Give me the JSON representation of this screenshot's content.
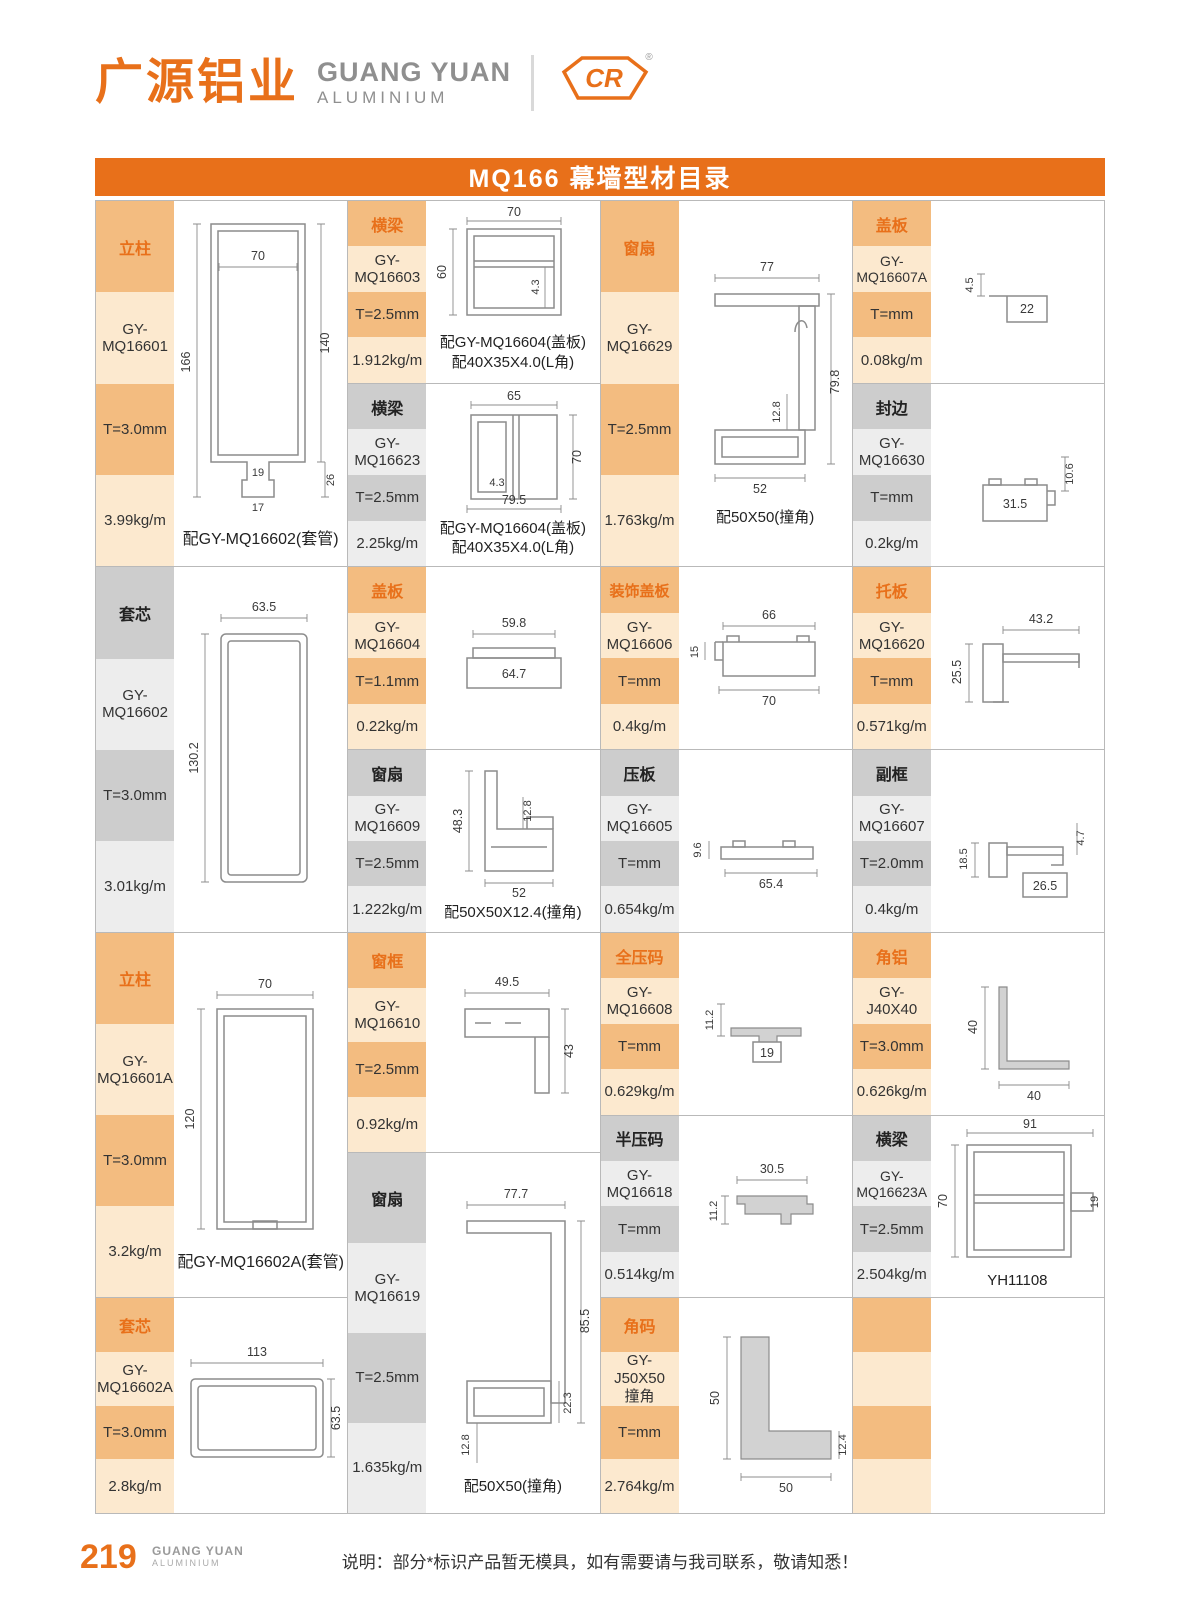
{
  "title": "MQ166 幕墙型材目录",
  "header": {
    "logo_cn": "广源铝业",
    "logo_en": "GUANG YUAN",
    "logo_en_sub": "ALUMINIUM",
    "badge": "CR",
    "registered": "®"
  },
  "footer": {
    "page": "219",
    "brand": "GUANG YUAN",
    "brand_sub": "ALUMINIUM",
    "note": "说明：部分*标识产品暂无模具，如有需要请与我司联系，敬请知悉！"
  },
  "colors": {
    "brand_orange": "#E8701A",
    "cell_orange_dark": "#F3BC80",
    "cell_orange_light": "#FCE9CF",
    "cell_gray_dark": "#CDCDCD",
    "cell_gray_light": "#EDEDED"
  },
  "columns": [
    {
      "blocks": [
        {
          "category": "立柱",
          "code": "GY-MQ16601",
          "thickness": "T=3.0mm",
          "weight": "3.99kg/m",
          "caption": [
            "配GY-MQ16602(套管)"
          ],
          "dims": [
            "70",
            "166",
            "140",
            "19",
            "26",
            "17"
          ]
        },
        {
          "category": "套芯",
          "code": "GY-MQ16602",
          "thickness": "T=3.0mm",
          "weight": "3.01kg/m",
          "caption": [],
          "dims": [
            "63.5",
            "130.2"
          ]
        },
        {
          "category": "立柱",
          "code": "GY-MQ16601A",
          "thickness": "T=3.0mm",
          "weight": "3.2kg/m",
          "caption": [
            "配GY-MQ16602A(套管)"
          ],
          "dims": [
            "70",
            "120"
          ]
        },
        {
          "category": "套芯",
          "code": "GY-MQ16602A",
          "thickness": "T=3.0mm",
          "weight": "2.8kg/m",
          "caption": [],
          "dims": [
            "113",
            "63.5"
          ]
        }
      ]
    },
    {
      "blocks": [
        {
          "category": "横梁",
          "code": "GY-MQ16603",
          "thickness": "T=2.5mm",
          "weight": "1.912kg/m",
          "caption": [
            "配GY-MQ16604(盖板)",
            "配40X35X4.0(L角)"
          ],
          "dims": [
            "70",
            "60",
            "4.3"
          ]
        },
        {
          "category": "横梁",
          "code": "GY-MQ16623",
          "thickness": "T=2.5mm",
          "weight": "2.25kg/m",
          "caption": [
            "配GY-MQ16604(盖板)",
            "配40X35X4.0(L角)"
          ],
          "dims": [
            "65",
            "4.3",
            "70",
            "79.5"
          ]
        },
        {
          "category": "盖板",
          "code": "GY-MQ16604",
          "thickness": "T=1.1mm",
          "weight": "0.22kg/m",
          "caption": [],
          "dims": [
            "59.8",
            "64.7"
          ]
        },
        {
          "category": "窗扇",
          "code": "GY-MQ16609",
          "thickness": "T=2.5mm",
          "weight": "1.222kg/m",
          "caption": [
            "配50X50X12.4(撞角)"
          ],
          "dims": [
            "48.3",
            "12.8",
            "52"
          ]
        },
        {
          "category": "窗框",
          "code": "GY-MQ16610",
          "thickness": "T=2.5mm",
          "weight": "0.92kg/m",
          "caption": [],
          "dims": [
            "49.5",
            "43"
          ]
        },
        {
          "category": "窗扇",
          "code": "GY-MQ16619",
          "thickness": "T=2.5mm",
          "weight": "1.635kg/m",
          "caption": [
            "配50X50(撞角)"
          ],
          "dims": [
            "77.7",
            "85.5",
            "22.3",
            "12.8"
          ]
        }
      ]
    },
    {
      "blocks": [
        {
          "category": "窗扇",
          "code": "GY-MQ16629",
          "thickness": "T=2.5mm",
          "weight": "1.763kg/m",
          "caption": [
            "配50X50(撞角)"
          ],
          "dims": [
            "77",
            "79.8",
            "12.8",
            "52"
          ]
        },
        {
          "category": "装饰盖板",
          "code": "GY-MQ16606",
          "thickness": "T=mm",
          "weight": "0.4kg/m",
          "caption": [],
          "dims": [
            "66",
            "15",
            "70"
          ]
        },
        {
          "category": "压板",
          "code": "GY-MQ16605",
          "thickness": "T=mm",
          "weight": "0.654kg/m",
          "caption": [],
          "dims": [
            "9.6",
            "65.4"
          ]
        },
        {
          "category": "全压码",
          "code": "GY-MQ16608",
          "thickness": "T=mm",
          "weight": "0.629kg/m",
          "caption": [],
          "dims": [
            "11.2",
            "19"
          ]
        },
        {
          "category": "半压码",
          "code": "GY-MQ16618",
          "thickness": "T=mm",
          "weight": "0.514kg/m",
          "caption": [],
          "dims": [
            "30.5",
            "11.2"
          ]
        },
        {
          "category": "角码",
          "code": "GY-J50X50",
          "code_sub": "撞角",
          "thickness": "T=mm",
          "weight": "2.764kg/m",
          "caption": [],
          "dims": [
            "50",
            "50",
            "12.4"
          ]
        }
      ]
    },
    {
      "blocks": [
        {
          "category": "盖板",
          "code": "GY-MQ16607A",
          "thickness": "T=mm",
          "weight": "0.08kg/m",
          "caption": [],
          "dims": [
            "4.5",
            "22"
          ]
        },
        {
          "category": "封边",
          "code": "GY-MQ16630",
          "thickness": "T=mm",
          "weight": "0.2kg/m",
          "caption": [],
          "dims": [
            "10.6",
            "31.5"
          ]
        },
        {
          "category": "托板",
          "code": "GY-MQ16620",
          "thickness": "T=mm",
          "weight": "0.571kg/m",
          "caption": [],
          "dims": [
            "43.2",
            "25.5"
          ]
        },
        {
          "category": "副框",
          "code": "GY-MQ16607",
          "thickness": "T=2.0mm",
          "weight": "0.4kg/m",
          "caption": [],
          "dims": [
            "18.5",
            "4.7",
            "26.5"
          ]
        },
        {
          "category": "角铝",
          "code": "GY-J40X40",
          "thickness": "T=3.0mm",
          "weight": "0.626kg/m",
          "caption": [],
          "dims": [
            "40",
            "40"
          ]
        },
        {
          "category": "横梁",
          "code": "GY-MQ16623A",
          "thickness": "T=2.5mm",
          "weight": "2.504kg/m",
          "caption": [
            "YH11108"
          ],
          "dims": [
            "91",
            "70",
            "19"
          ]
        },
        {
          "category": "",
          "code": "",
          "thickness": "",
          "weight": "",
          "caption": [],
          "dims": []
        }
      ]
    }
  ]
}
